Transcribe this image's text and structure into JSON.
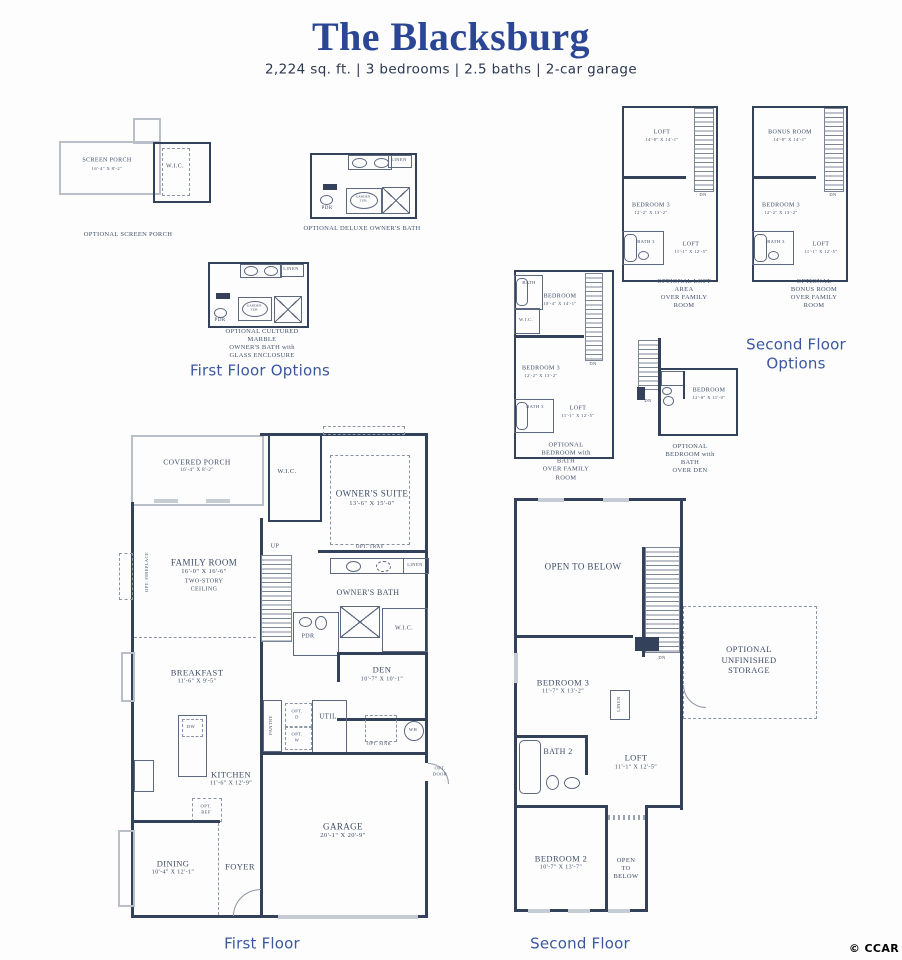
{
  "colors": {
    "title_blue": "#2a4694",
    "heading_blue": "#3a57a0",
    "wall_dark": "#33425a",
    "label_ink": "#3c4c66"
  },
  "header": {
    "title": "The Blacksburg",
    "specs": "2,224 sq. ft. | 3 bedrooms | 2.5 baths | 2-car garage"
  },
  "section_labels": {
    "first_floor_options": "First Floor Options",
    "second_floor_options": "Second Floor\nOptions"
  },
  "footer": {
    "first_floor_label": "First Floor",
    "second_floor_label": "Second Floor",
    "copyright": "© CCAR"
  },
  "ff_options": {
    "screen_porch": {
      "caption": "OPTIONAL SCREEN PORCH",
      "room": {
        "name": "SCREEN PORCH",
        "dims": "16'-4\" X 8'-2\""
      },
      "wic": "W.I.C."
    },
    "deluxe_bath": {
      "caption": "OPTIONAL DELUXE OWNER'S BATH",
      "linen": "LINEN",
      "tub": "GARDEN\nTUB",
      "pdr": "PDR"
    },
    "marble_bath": {
      "caption": "OPTIONAL CULTURED  MARBLE\nOWNER'S BATH with GLASS ENCLOSURE",
      "linen": "LINEN",
      "tub": "GARDEN\nTUB",
      "pdr": "PDR"
    }
  },
  "sf_options": {
    "loft_area": {
      "caption": "OPTIONAL LOFT AREA\nOVER FAMILY ROOM",
      "loft_top": {
        "name": "LOFT",
        "dims": "14'-0\" X 14'-1\""
      },
      "bedroom3": {
        "name": "BEDROOM 3",
        "dims": "12'-2\" X 13'-2\""
      },
      "bath3": "BATH 3",
      "loft": {
        "name": "LOFT",
        "dims": "11'-1\" X 12'-5\""
      },
      "dn": "DN"
    },
    "bonus_room": {
      "caption": "OPTIONAL BONUS ROOM\nOVER FAMILY ROOM",
      "bonus": {
        "name": "BONUS ROOM",
        "dims": "14'-0\" X 14'-1\""
      },
      "bedroom3": {
        "name": "BEDROOM 3",
        "dims": "12'-2\" X 13'-2\""
      },
      "bath3": "BATH 3",
      "loft": {
        "name": "LOFT",
        "dims": "11'-1\" X 12'-5\""
      },
      "dn": "DN"
    },
    "bedroom_family": {
      "caption": "OPTIONAL BEDROOM with BATH\nOVER FAMILY ROOM",
      "bath": "BATH",
      "bedroom": {
        "name": "BEDROOM",
        "dims": "10'-4\" X 14'-1\""
      },
      "wic": "W.I.C.",
      "bedroom3": {
        "name": "BEDROOM 3",
        "dims": "12'-2\" X 13'-2\""
      },
      "bath3": "BATH 3",
      "loft": {
        "name": "LOFT",
        "dims": "11'-1\" X 12'-5\""
      },
      "dn": "DN"
    },
    "bedroom_den": {
      "caption": "OPTIONAL BEDROOM with BATH\nOVER DEN",
      "bedroom": {
        "name": "BEDROOM",
        "dims": "12'-0\" X 11'-0\""
      },
      "dn": "DN"
    }
  },
  "first_floor": {
    "covered_porch": {
      "name": "COVERED PORCH",
      "dims": "16'-4\" X 8'-2\""
    },
    "wic_top": "W.I.C.",
    "owners_suite": {
      "name": "OWNER'S SUITE",
      "dims": "13'-6\" X 15'-0\""
    },
    "opt_tray": "OPT. TRAY",
    "family_room": {
      "name": "FAMILY ROOM",
      "dims": "16'-0\" X 16'-6\"",
      "note": "TWO-STORY\nCEILING"
    },
    "opt_fireplace": "OPT. FIREPLACE",
    "up": "UP",
    "owners_bath": "OWNER'S BATH",
    "linen": "LINEN",
    "pdr": "PDR",
    "wic_mid": "W.I.C.",
    "den": {
      "name": "DEN",
      "dims": "10'-7\" X 10'-1\""
    },
    "breakfast": {
      "name": "BREAKFAST",
      "dims": "11'-6\" X 9'-5\""
    },
    "pantry": "PANTRY",
    "opt_d": "OPT.\nD",
    "opt_w": "OPT.\nW",
    "util": "UTIL",
    "opt_sink": "OPT. SINK",
    "wh": "WH",
    "kitchen": {
      "name": "KITCHEN",
      "dims": "11'-6\" X 12'-9\""
    },
    "dw": "DW",
    "opt_ref": "OPT.\nREF",
    "dining": {
      "name": "DINING",
      "dims": "10'-4\" X 12'-1\""
    },
    "foyer": "FOYER",
    "garage": {
      "name": "GARAGE",
      "dims": "20'-1\" X 20'-9\""
    },
    "opt_door": "OPT.\nDOOR"
  },
  "second_floor": {
    "open_to_below": "OPEN TO BELOW",
    "dn": "DN",
    "bedroom3": {
      "name": "BEDROOM 3",
      "dims": "11'-7\" X 13'-2\""
    },
    "linen": "LINEN",
    "bath2": "BATH 2",
    "loft": {
      "name": "LOFT",
      "dims": "11'-1\" X 12'-5\""
    },
    "bedroom2": {
      "name": "BEDROOM 2",
      "dims": "10'-7\" X 13'-7\""
    },
    "open_below_small": "OPEN\nTO\nBELOW",
    "storage": "OPTIONAL\nUNFINISHED\nSTORAGE"
  }
}
